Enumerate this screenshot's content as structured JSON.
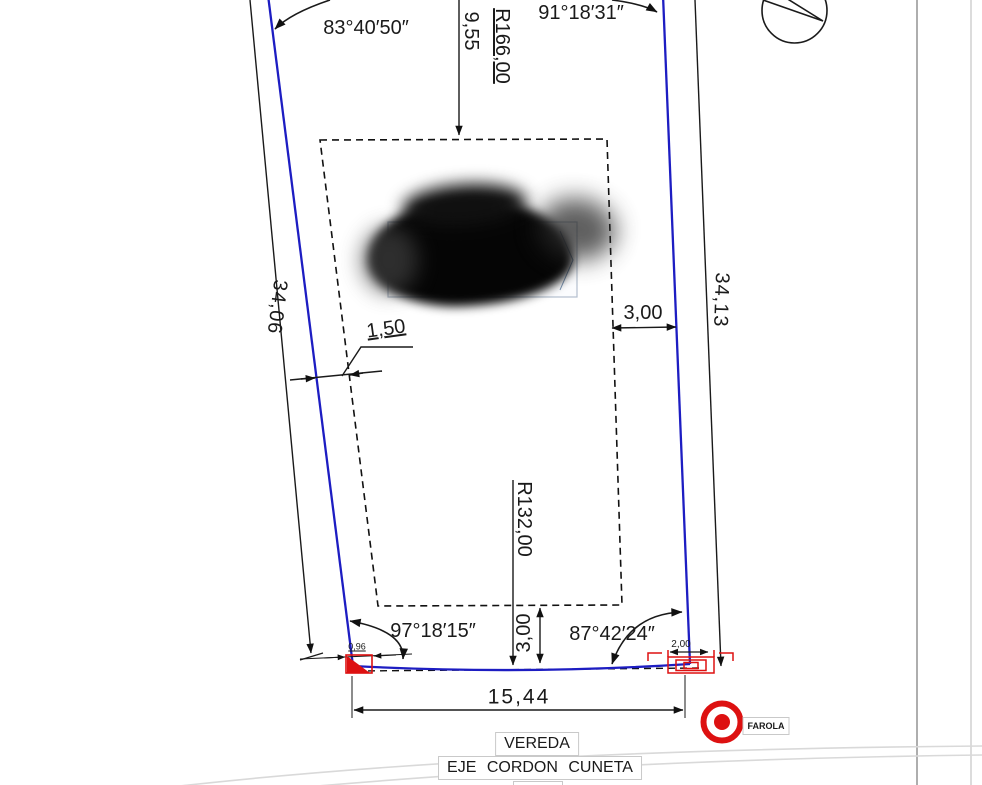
{
  "drawing": {
    "colors": {
      "boundary_blue": "#1d1dc2",
      "accent_red": "#dd1111",
      "line_black": "#1a1a1a"
    },
    "angles": {
      "top_left": "83°40′50″",
      "top_right": "91°18′31″",
      "bottom_left": "97°18′15″",
      "bottom_right": "87°42′24″"
    },
    "dimensions": {
      "side_left": "34,06",
      "side_right": "34,13",
      "frontage": "15,44",
      "top_offset": "9,55",
      "setback_left": "1,50",
      "setback_right": "3,00",
      "setback_bottom": "3,00",
      "corner_detail": "0,96",
      "entrance_width": "2,00"
    },
    "radii": {
      "top_curve": "R166,00",
      "bottom_curve": "R132,00"
    },
    "labels": {
      "vereda": "VEREDA",
      "eje_cordon": "EJE CORDON CUNETA",
      "farola": "FAROLA"
    },
    "symbols": {
      "farola": "streetlight-bullseye",
      "north": "circle-indicator",
      "redaction": "blacked-out-label"
    }
  }
}
